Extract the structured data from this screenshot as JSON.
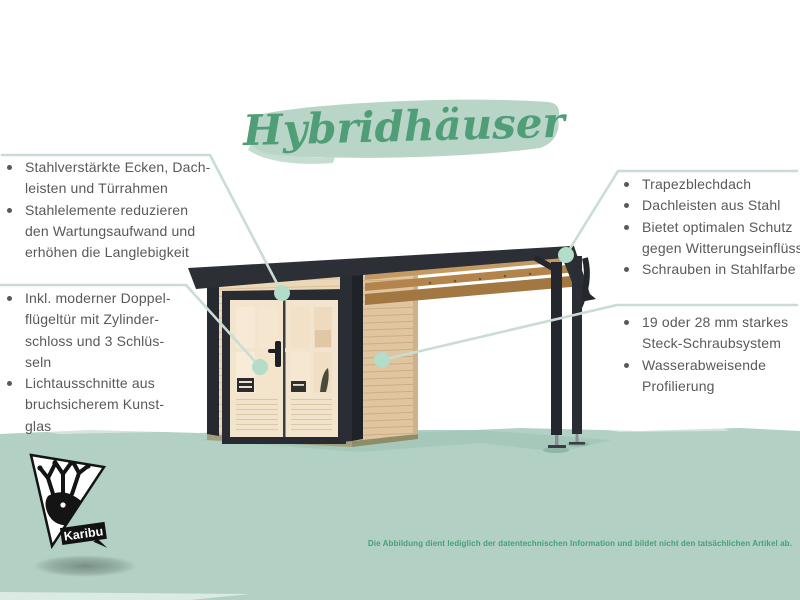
{
  "title": "Hybridhäuser",
  "callouts": {
    "left_top": {
      "items": [
        [
          "Stahlverstärkte Ecken, Dach-",
          "leisten und Türrahmen"
        ],
        [
          "Stahlelemente reduzieren",
          "den Wartungsaufwand und",
          "erhöhen die Langlebigkeit"
        ]
      ]
    },
    "left_bottom": {
      "items": [
        [
          "Inkl. moderner Doppel-",
          "flügeltür mit Zylinder-",
          "schloss und 3 Schlüs-",
          "seln"
        ],
        [
          "Lichtausschnitte aus",
          "bruchsicherem Kunst-",
          "glas"
        ]
      ]
    },
    "right_top": {
      "items": [
        [
          "Trapezblechdach"
        ],
        [
          "Dachleisten aus Stahl"
        ],
        [
          "Bietet optimalen Schutz",
          "gegen Witterungseinflüsse"
        ],
        [
          "Schrauben in Stahlfarbe"
        ]
      ]
    },
    "right_bottom": {
      "items": [
        [
          "19 oder 28 mm starkes",
          "Steck-Schraubsystem"
        ],
        [
          "Wasserabweisende",
          "Profilierung"
        ]
      ]
    }
  },
  "disclaimer": "Die Abbildung dient lediglich der datentechnischen Information und bildet nicht den tatsächlichen Artikel ab.",
  "logo": {
    "label": "Karibu"
  },
  "colors": {
    "title_green": "#4f9e78",
    "brush_green": "#b8d5c7",
    "ground_green": "#b2d0c4",
    "callout_line": "#c9ddd4",
    "callout_dot": "#b3dcc9",
    "text_gray": "#58595b",
    "disclaimer_green": "#45a077",
    "roof_dark": "#2c2f35",
    "wood_light": "#ecd7b6",
    "logo_black": "#141414"
  }
}
